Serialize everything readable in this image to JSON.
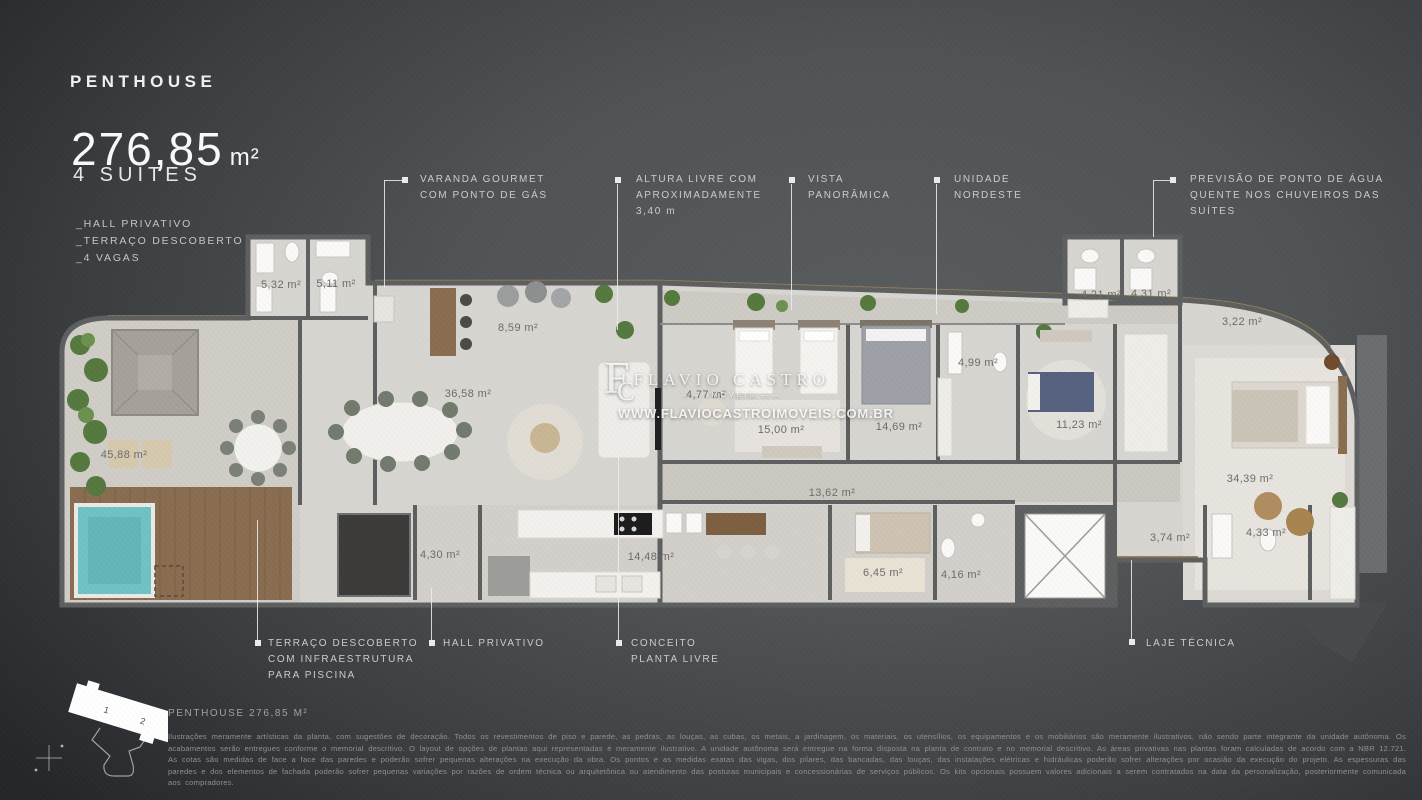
{
  "header": {
    "title": "PENTHOUSE",
    "area_value": "276,85",
    "area_unit": "m²",
    "subtitle": "4 SUÍTES",
    "features": [
      "_HALL PRIVATIVO",
      "_TERRAÇO DESCOBERTO",
      "_4 VAGAS"
    ]
  },
  "callouts": {
    "top": [
      {
        "lines": [
          "VARANDA GOURMET",
          "COM PONTO DE GÁS"
        ]
      },
      {
        "lines": [
          "ALTURA LIVRE COM",
          "APROXIMADAMENTE",
          "3,40 m"
        ]
      },
      {
        "lines": [
          "VISTA",
          "PANORÂMICA"
        ]
      },
      {
        "lines": [
          "UNIDADE",
          "NORDESTE"
        ]
      },
      {
        "lines": [
          "PREVISÃO DE PONTO DE ÁGUA",
          "QUENTE NOS CHUVEIROS DAS",
          "SUÍTES"
        ]
      }
    ],
    "bottom": [
      {
        "lines": [
          "TERRAÇO DESCOBERTO",
          "COM INFRAESTRUTURA",
          "PARA PISCINA"
        ]
      },
      {
        "lines": [
          "HALL PRIVATIVO"
        ]
      },
      {
        "lines": [
          "CONCEITO",
          "PLANTA LIVRE"
        ]
      },
      {
        "lines": [
          "LAJE TÉCNICA"
        ]
      }
    ]
  },
  "watermark": {
    "monogram_f": "F",
    "monogram_c": "C",
    "name": "FLAVIO CASTRO",
    "division": "IMÓVEIS",
    "url": "WWW.FLAVIOCASTROIMOVEIS.COM.BR"
  },
  "floorplan": {
    "rooms": [
      {
        "area": "5,32 m²"
      },
      {
        "area": "5,11 m²"
      },
      {
        "area": "8,59 m²"
      },
      {
        "area": "45,88 m²"
      },
      {
        "area": "36,58 m²"
      },
      {
        "area": "4,77 m²"
      },
      {
        "area": "15,00 m²"
      },
      {
        "area": "14,69 m²"
      },
      {
        "area": "4,99 m²"
      },
      {
        "area": "11,23 m²"
      },
      {
        "area": "4,21 m²"
      },
      {
        "area": "4,31 m²"
      },
      {
        "area": "3,22 m²"
      },
      {
        "area": "34,39 m²"
      },
      {
        "area": "13,62 m²"
      },
      {
        "area": "4,30 m²"
      },
      {
        "area": "14,48 m²"
      },
      {
        "area": "6,45 m²"
      },
      {
        "area": "4,16 m²"
      },
      {
        "area": "3,74 m²"
      },
      {
        "area": "4,33 m²"
      }
    ]
  },
  "keyplan": {
    "labels": [
      "1",
      "2"
    ]
  },
  "footer": {
    "caption": "PENTHOUSE 276,85 M²",
    "disclaimer": "Ilustrações meramente artísticas da planta, com sugestões de decoração. Todos os revestimentos de piso e parede, as pedras, as louças, as cubas, os metais, a jardinagem, os materiais, os utensílios, os equipamentos e os mobiliários são meramente ilustrativos, não sendo parte integrante da unidade autônoma. Os acabamentos serão entregues conforme o memorial descritivo. O layout de opções de plantas aqui representadas é meramente ilustrativo. A unidade autônoma será entregue na forma disposta na planta de contrato e no memorial descritivo. As áreas privativas nas plantas foram calculadas de acordo com a NBR 12.721. As cotas são medidas de face a face das paredes e poderão sofrer pequenas alterações na execução da obra. Os pontos e as medidas exatas das vigas, dos pilares, das bancadas, das louças, das instalações elétricas e hidráulicas poderão sofrer alterações por ocasião da execução do projeto. As espessuras das paredes e dos elementos de fachada poderão sofrer pequenas variações por razões de ordem técnica ou arquitetônica ou atendimento das posturas municipais e concessionárias de serviços públicos. Os kits opcionais possuem valores adicionais a serem contratados na data da personalização, posteriormente comunicada aos compradores."
  },
  "colors": {
    "background": "#505356",
    "gold_trim": "#9b8350",
    "pool": "#6fc2c4",
    "wall": "#5d5f60",
    "floor": "#d8d6d1"
  }
}
